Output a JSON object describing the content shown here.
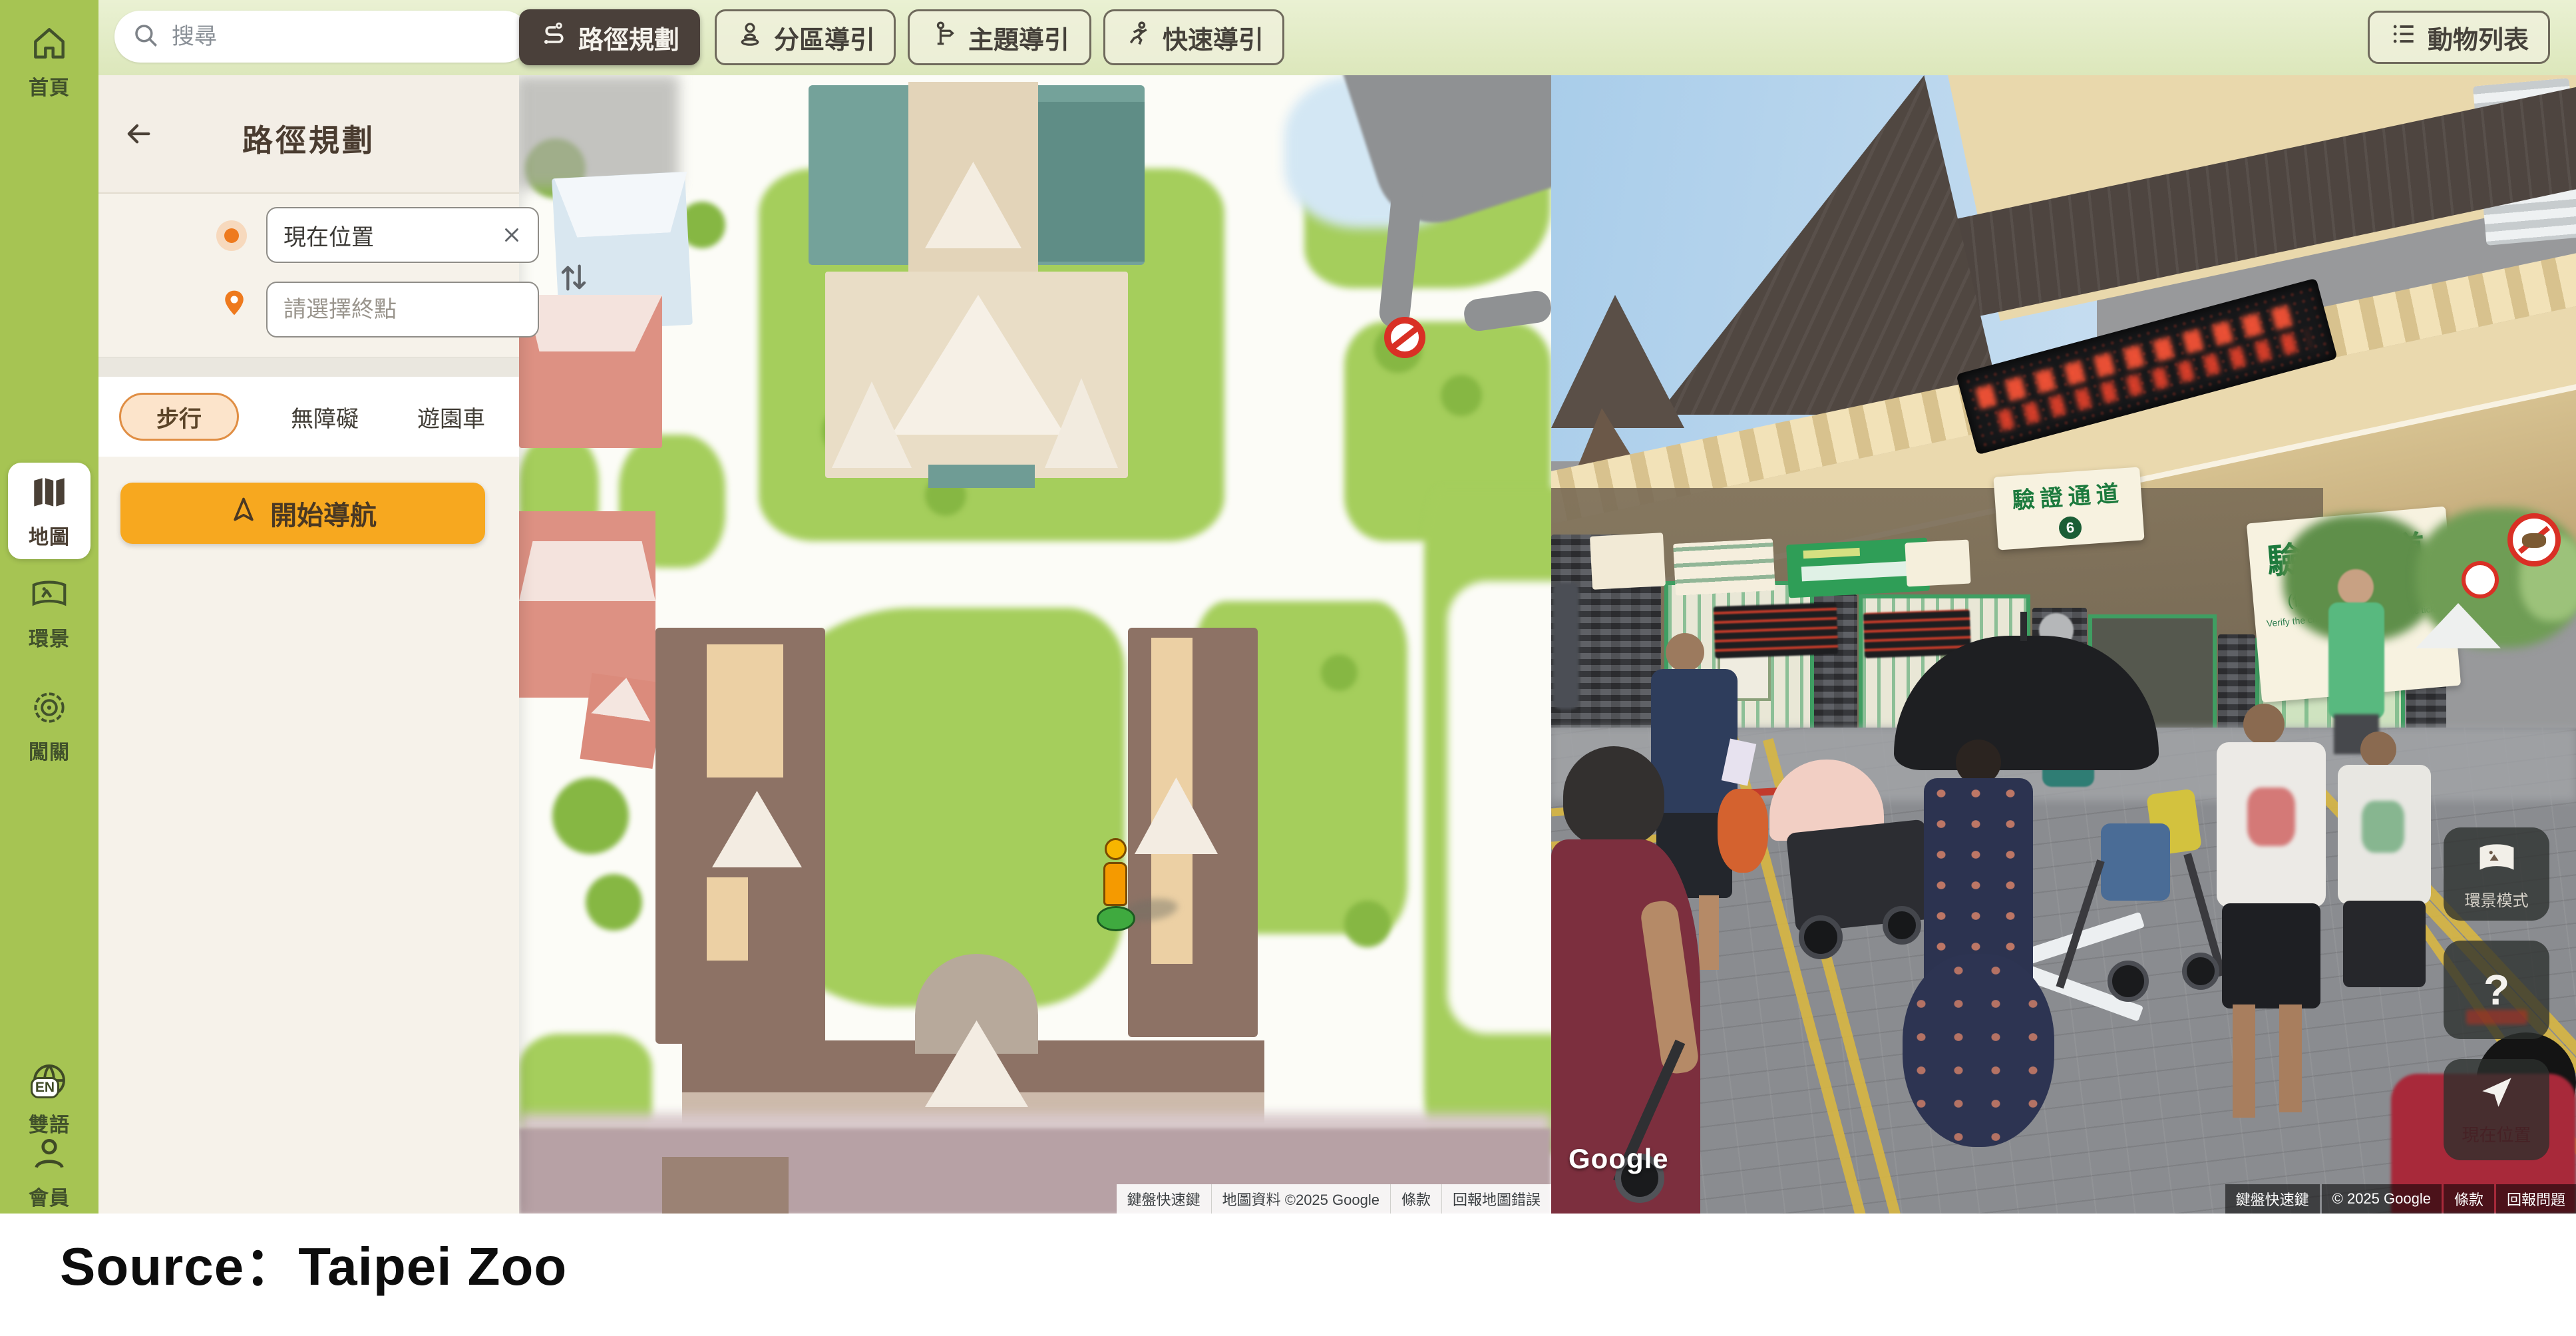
{
  "page": {
    "source_caption": "Source：Taipei Zoo"
  },
  "sidebar": {
    "items": [
      {
        "id": "home",
        "label": "首頁"
      },
      {
        "id": "map",
        "label": "地圖"
      },
      {
        "id": "panorama",
        "label": "環景"
      },
      {
        "id": "challenge",
        "label": "闖關"
      },
      {
        "id": "language",
        "label": "雙語",
        "badge": "EN"
      },
      {
        "id": "member",
        "label": "會員"
      }
    ]
  },
  "topbar": {
    "search_placeholder": "搜尋",
    "nav_tabs": [
      {
        "label": "路徑規劃"
      },
      {
        "label": "分區導引"
      },
      {
        "label": "主題導引"
      },
      {
        "label": "快速導引"
      }
    ],
    "animal_list": "動物列表"
  },
  "route_panel": {
    "title": "路徑規劃",
    "origin_value": "現在位置",
    "destination_placeholder": "請選擇終點",
    "modes": [
      {
        "label": "步行"
      },
      {
        "label": "無障礙"
      },
      {
        "label": "遊園車"
      }
    ],
    "start_nav": "開始導航"
  },
  "map_pane": {
    "attribution": [
      "鍵盤快速鍵",
      "地圖資料 ©2025 Google",
      "條款",
      "回報地圖錯誤"
    ]
  },
  "street_pane": {
    "google": "Google",
    "sign_main": {
      "title": "驗證通道",
      "subtitle": "(優待票/免票/全票)",
      "subtext": "Verify the channel(General electronic ticket card)",
      "number": "5"
    },
    "sign_mid": {
      "title": "驗證通道",
      "number": "6"
    },
    "controls": {
      "panorama_mode": "環景模式",
      "help": "?",
      "locate": "現在位置"
    },
    "attribution": [
      "鍵盤快速鍵",
      "© 2025 Google",
      "條款",
      "回報問題"
    ]
  },
  "colors": {
    "accent_orange": "#F7A81F",
    "brand_green": "#A6C453",
    "selected_brown": "#4A403A"
  }
}
